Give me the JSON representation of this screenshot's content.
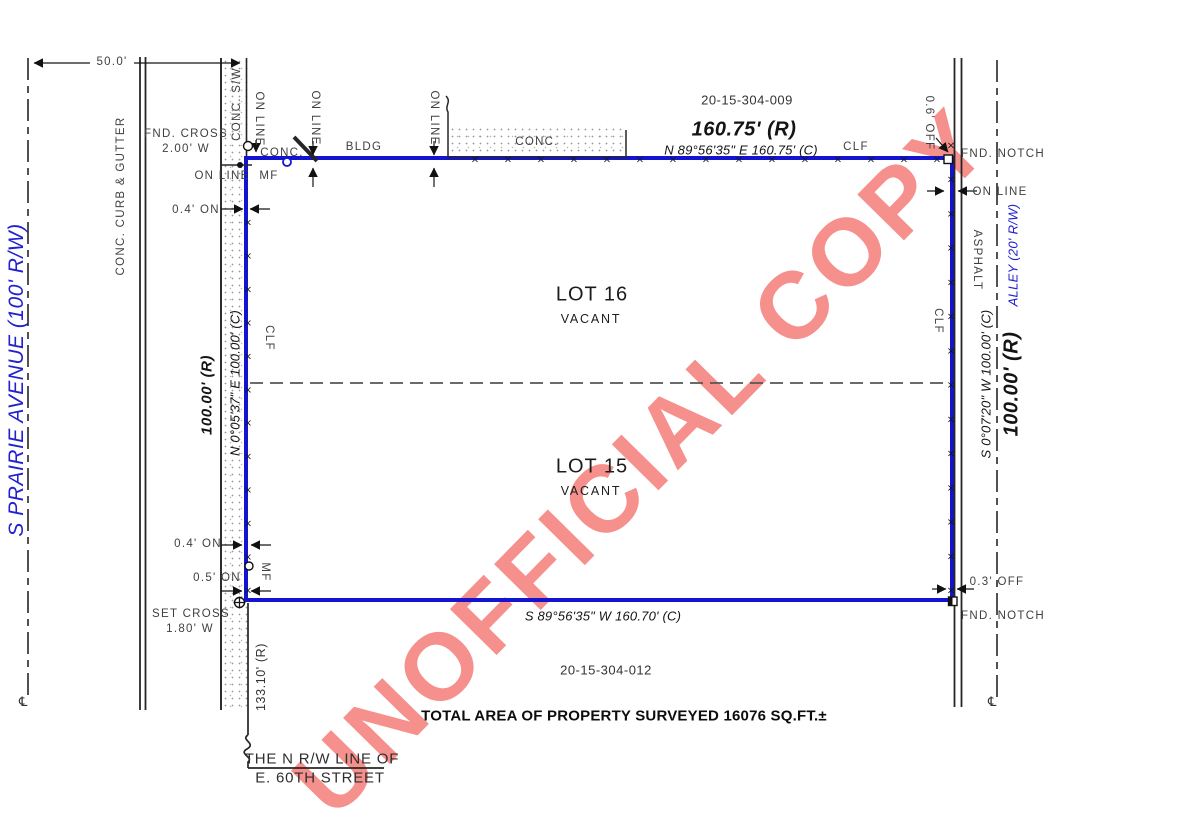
{
  "watermark": {
    "text": "UNOFFICIAL COPY",
    "color": "#f5908c"
  },
  "streets": {
    "west": "S PRAIRIE AVENUE (100' R/W)",
    "alley": "ALLEY (20' R/W)",
    "south_rw_1": "THE N R/W LINE OF",
    "south_rw_2": "E. 60TH STREET"
  },
  "parcels": {
    "pin_north": "20-15-304-009",
    "pin_south": "20-15-304-012",
    "lot16": "LOT 16",
    "lot15": "LOT 15",
    "vacant": "VACANT"
  },
  "boundary": {
    "north_record": "160.75' (R)",
    "north_bearing": "N 89°56'35\" E  160.75' (C)",
    "south_bearing": "S 89°56'35\" W  160.70' (C)",
    "west_record": "100.00' (R)",
    "west_bearing": "N 0°05'37\" E  100.00' (C)",
    "east_record": "100.00' (R)",
    "east_bearing": "S 0°07'20\" W  100.00' (C)",
    "south_offset_record": "133.10' (R)"
  },
  "annotations": {
    "dim_west_half": "50.0'",
    "curb": "CONC. CURB & GUTTER",
    "sidewalk": "CONC. S/W",
    "fnd_cross": "FND. CROSS",
    "fnd_cross_off": "2.00' W",
    "set_cross": "SET CROSS",
    "set_cross_off": "1.80' W",
    "on_line": "ON LINE",
    "mf": "MF",
    "clf": "CLF",
    "bldg": "BLDG",
    "conc": "CONC.",
    "asphalt": "ASPHALT",
    "fnd_notch": "FND. NOTCH",
    "on_04": "0.4' ON",
    "on_05": "0.5' ON",
    "off_03": "0.3' OFF",
    "off_06": "0.6' OFF"
  },
  "summary": {
    "total_area": "TOTAL AREA OF PROPERTY SURVEYED 16076 SQ.FT.±"
  },
  "colors": {
    "boundary_blue": "#1414d0",
    "street_blue": "#2121cf",
    "watermark_red": "#f5908c",
    "linework": "#262626"
  }
}
